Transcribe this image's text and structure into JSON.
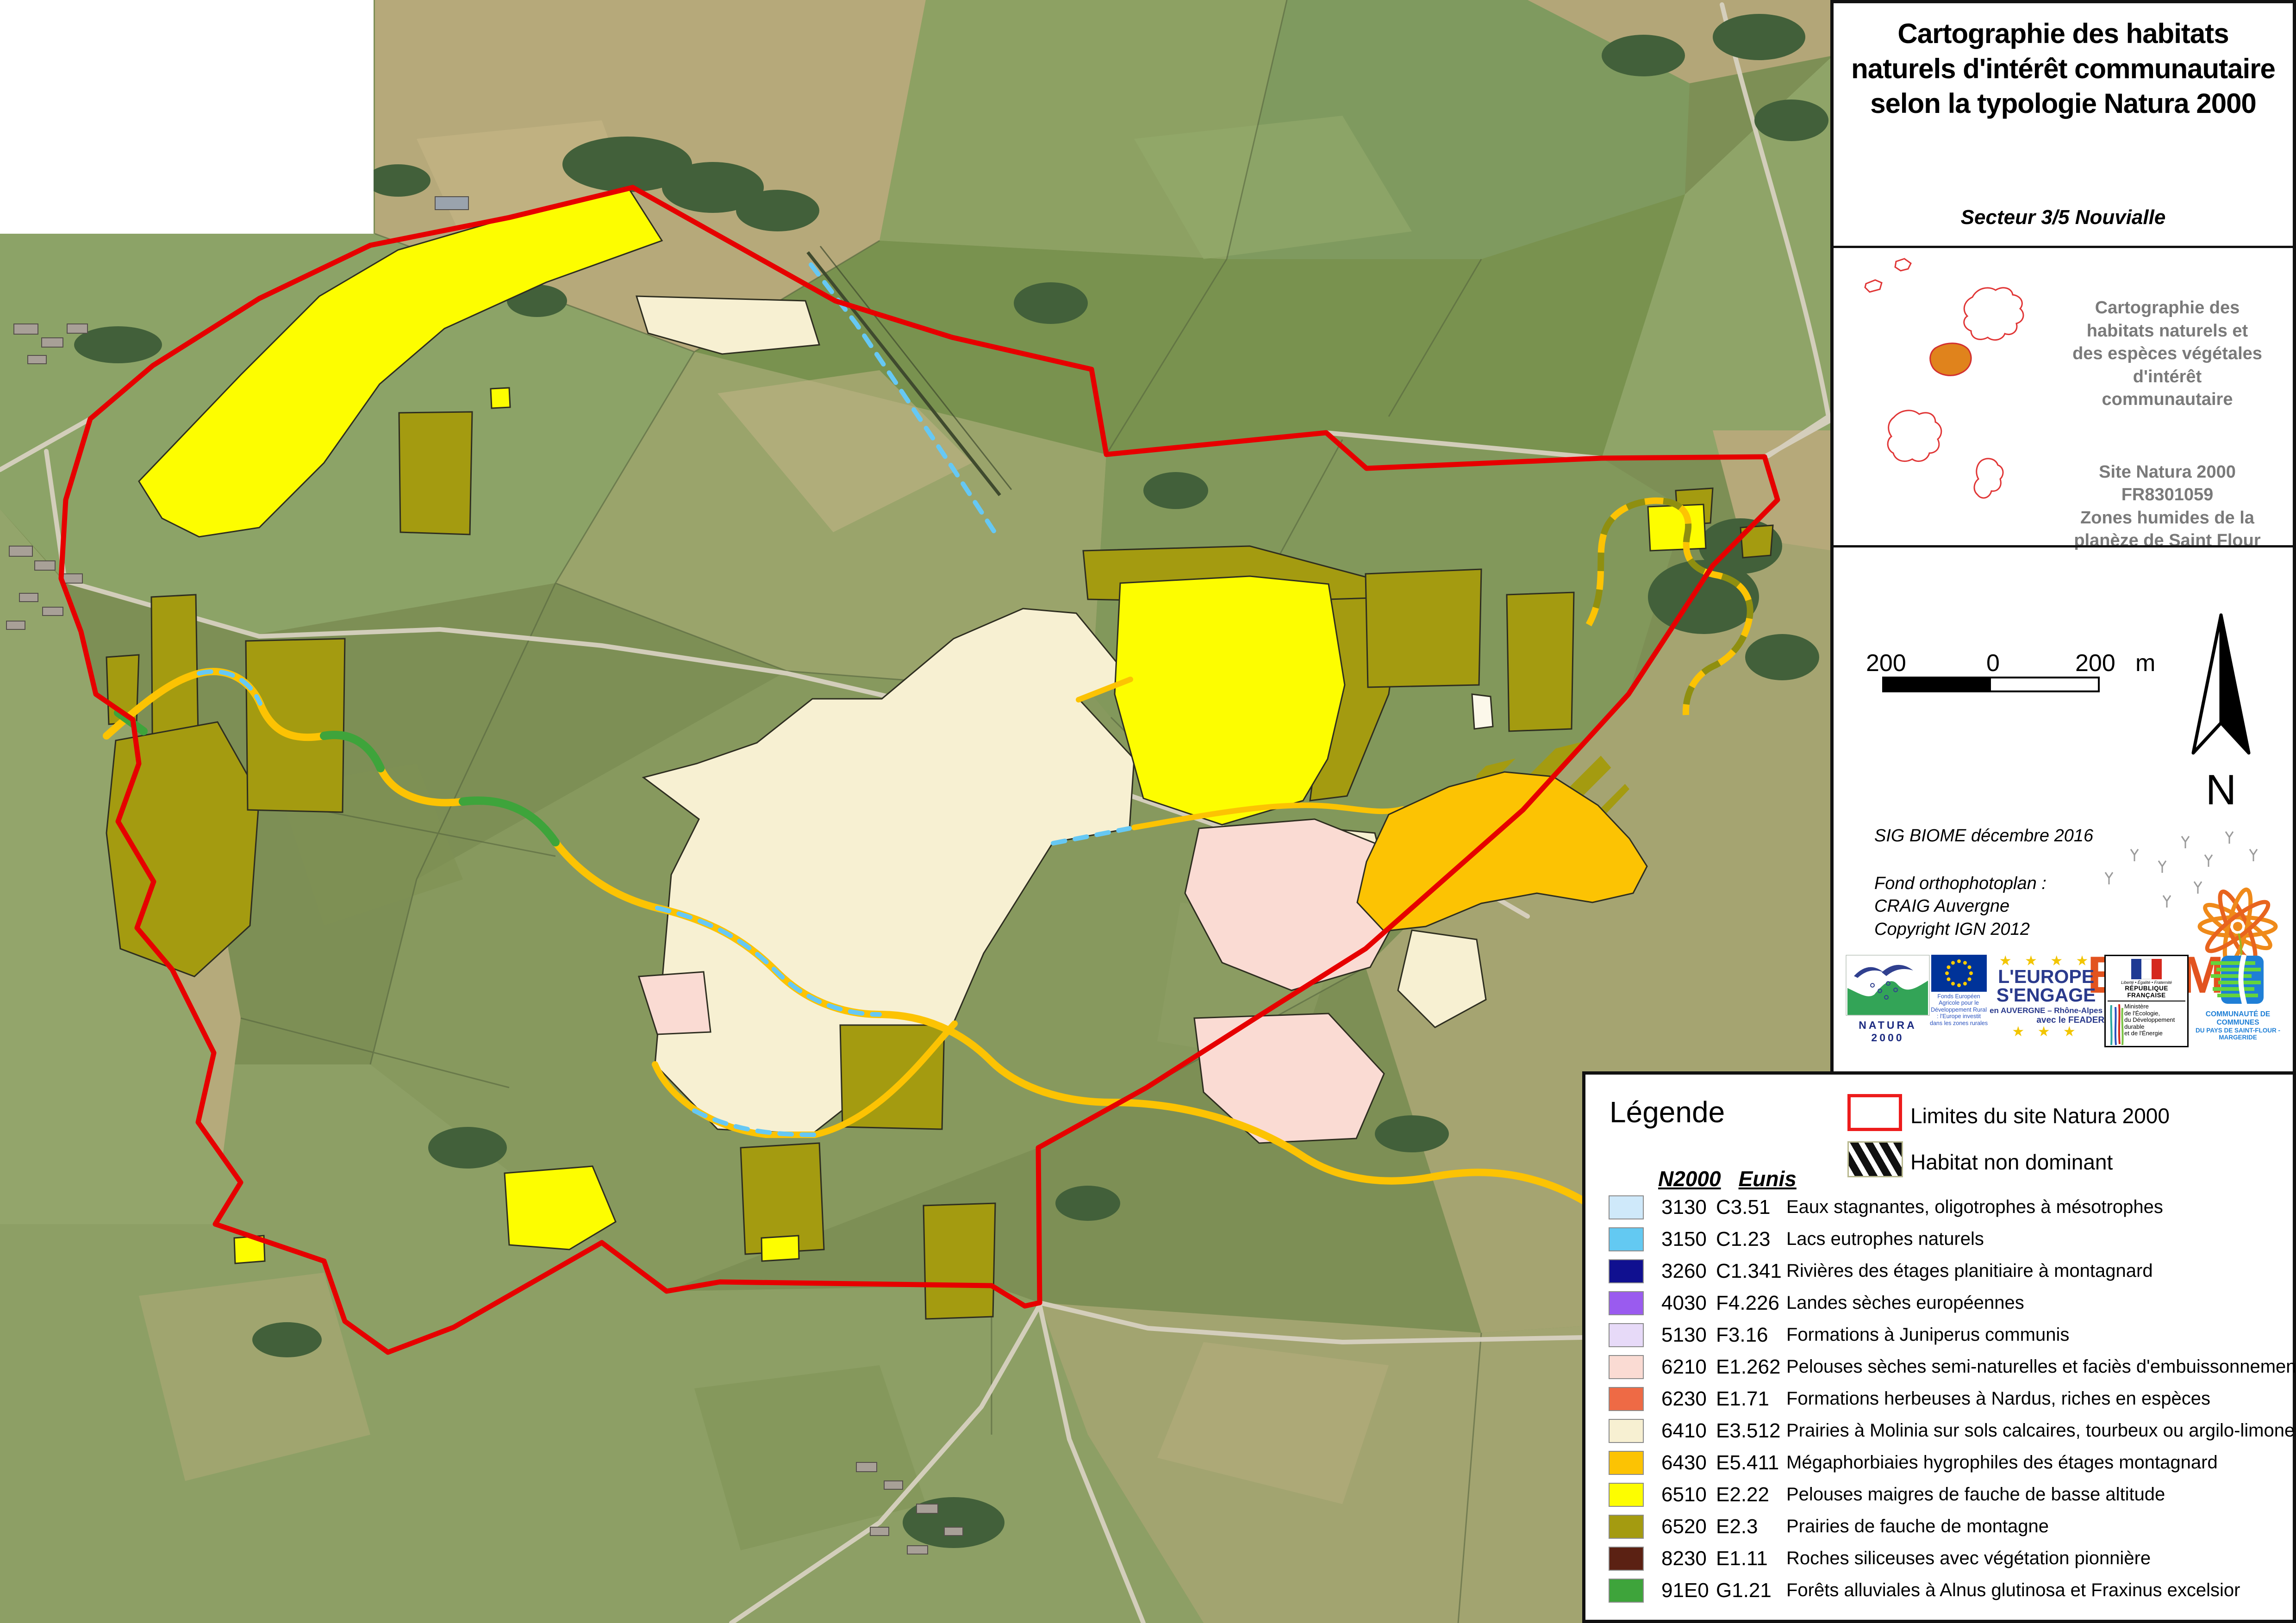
{
  "sidebar": {
    "title": "Cartographie des habitats\nnaturels d'intérêt communautaire\nselon la typologie Natura 2000",
    "sector": "Secteur 3/5  Nouvialle",
    "inset_description": "Cartographie des\nhabitats naturels et\ndes espèces végétales\nd'intérêt\ncommunautaire",
    "site_reference": "Site Natura 2000\nFR8301059\nZones humides de la\nplanèze de Saint Flour",
    "scale": {
      "left": "200",
      "zero": "0",
      "right": "200",
      "unit": "m",
      "north": "N"
    },
    "credits": {
      "sig": "SIG BIOME décembre 2016",
      "sources": "Fond orthophotoplan :\nCRAIG Auvergne\nCopyright IGN 2012"
    },
    "biome_logo": "BIOME",
    "logos": {
      "natura2000": "NATURA 2000",
      "eu_caption": "Fonds Européen Agricole pour le Développement Rural : l'Europe investit dans les zones rurales",
      "europe_line1": "L'EUROPE",
      "europe_line2": "S'ENGAGE",
      "europe_sub1": "en AUVERGNE – Rhône-Alpes",
      "europe_sub2": "avec le FEADER",
      "rf_motto": "Liberté • Égalité • Fraternité",
      "rf": "RÉPUBLIQUE FRANÇAISE",
      "ministere": "Ministère\nde l'Écologie,\ndu Développement\ndurable\net de l'Énergie",
      "cc_line1": "COMMUNAUTÉ DE COMMUNES",
      "cc_line2": "DU PAYS DE SAINT-FLOUR - MARGERIDE"
    }
  },
  "legend": {
    "title": "Légende",
    "boundary_label": "Limites du site Natura 2000",
    "boundary_color": "#e60000",
    "non_dominant_label": "Habitat non dominant",
    "col_n2000": "N2000",
    "col_eunis": "Eunis",
    "items": [
      {
        "n2000": "3130",
        "eunis": "C3.51",
        "label": "Eaux stagnantes, oligotrophes à mésotrophes",
        "color": "#cfe9fa"
      },
      {
        "n2000": "3150",
        "eunis": "C1.23",
        "label": "Lacs eutrophes naturels",
        "color": "#63c9f2"
      },
      {
        "n2000": "3260",
        "eunis": "C1.341",
        "label": "Rivières des étages planitiaire à montagnard",
        "color": "#101090"
      },
      {
        "n2000": "4030",
        "eunis": "F4.226",
        "label": "Landes sèches européennes",
        "color": "#9a5bef"
      },
      {
        "n2000": "5130",
        "eunis": "F3.16",
        "label": "Formations à Juniperus communis",
        "color": "#e7daf8"
      },
      {
        "n2000": "6210",
        "eunis": "E1.262",
        "label": "Pelouses sèches semi-naturelles et faciès d'embuissonnement",
        "color": "#fadbd3"
      },
      {
        "n2000": "6230",
        "eunis": "E1.71",
        "label": "Formations herbeuses à Nardus, riches en espèces",
        "color": "#ee6a45"
      },
      {
        "n2000": "6410",
        "eunis": "E3.512",
        "label": "Prairies à Molinia sur sols calcaires, tourbeux ou argilo-limoneux",
        "color": "#f7f0d2"
      },
      {
        "n2000": "6430",
        "eunis": "E5.411",
        "label": "Mégaphorbiaies hygrophiles des étages montagnard",
        "color": "#fcc303"
      },
      {
        "n2000": "6510",
        "eunis": "E2.22",
        "label": "Pelouses maigres de fauche de basse altitude",
        "color": "#fdfd00"
      },
      {
        "n2000": "6520",
        "eunis": "E2.3",
        "label": "Prairies de fauche de montagne",
        "color": "#a49b10"
      },
      {
        "n2000": "8230",
        "eunis": "E1.11",
        "label": "Roches siliceuses avec végétation pionnière",
        "color": "#5b2113"
      },
      {
        "n2000": "91E0",
        "eunis": "G1.21",
        "label": "Forêts alluviales à Alnus glutinosa et Fraxinus excelsior",
        "color": "#3ea43b"
      }
    ]
  }
}
